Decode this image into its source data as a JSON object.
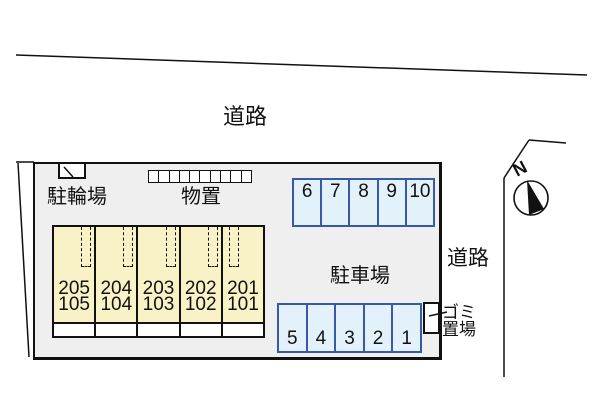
{
  "diagram": {
    "road_top": "道路",
    "road_right": "道路",
    "bicycle_parking": "駐輪場",
    "storage": "物置",
    "parking_lot": "駐車場",
    "trash_area": {
      "line1": "ゴミ",
      "line2": "置場"
    },
    "compass": {
      "north": "N"
    }
  },
  "building": {
    "units": [
      {
        "upper": "205",
        "lower": "105"
      },
      {
        "upper": "204",
        "lower": "104"
      },
      {
        "upper": "203",
        "lower": "103"
      },
      {
        "upper": "202",
        "lower": "102"
      },
      {
        "upper": "201",
        "lower": "101"
      }
    ],
    "storage_cell_count": 10
  },
  "parking": {
    "top_row": [
      "6",
      "7",
      "8",
      "9",
      "10"
    ],
    "bottom_row": [
      "5",
      "4",
      "3",
      "2",
      "1"
    ]
  },
  "colors": {
    "site_fill": "#EFEFEF",
    "building_fill": "#F9F2C6",
    "space_fill": "#E2F1FA",
    "space_border": "#3A57A8",
    "outline": "#111111"
  }
}
